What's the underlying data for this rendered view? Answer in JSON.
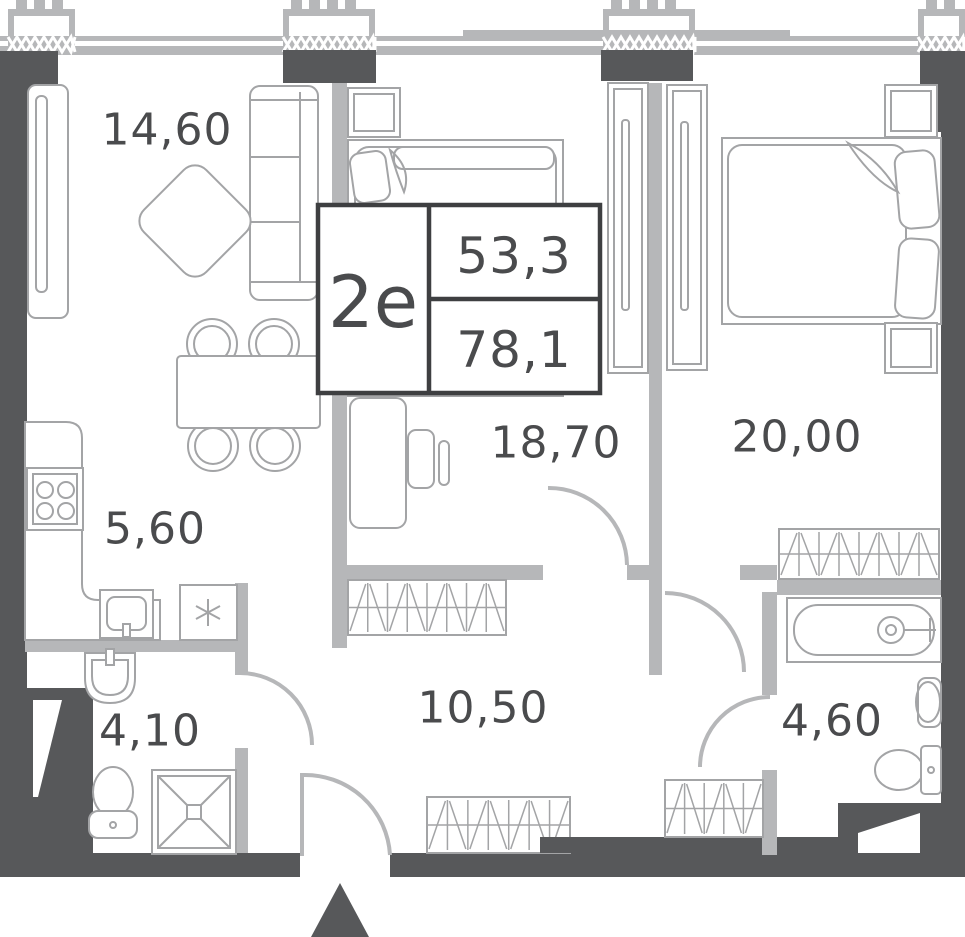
{
  "plan": {
    "unit_label": "2е",
    "living_area": "53,3",
    "total_area": "78,1",
    "rooms": [
      {
        "name": "living-room",
        "area": "14,60"
      },
      {
        "name": "kitchen",
        "area": "5,60"
      },
      {
        "name": "bathroom-small",
        "area": "4,10"
      },
      {
        "name": "hallway",
        "area": "10,50"
      },
      {
        "name": "bedroom-1",
        "area": "18,70"
      },
      {
        "name": "bedroom-2",
        "area": "20,00"
      },
      {
        "name": "bathroom-large",
        "area": "4,60"
      }
    ],
    "colors": {
      "wall_dark": "#57585A",
      "wall_light": "#B6B7B9",
      "furniture_line": "#A3A4A6",
      "label_text": "#4A4B4D",
      "info_border": "#3E3F41",
      "background": "#FFFFFF"
    }
  }
}
